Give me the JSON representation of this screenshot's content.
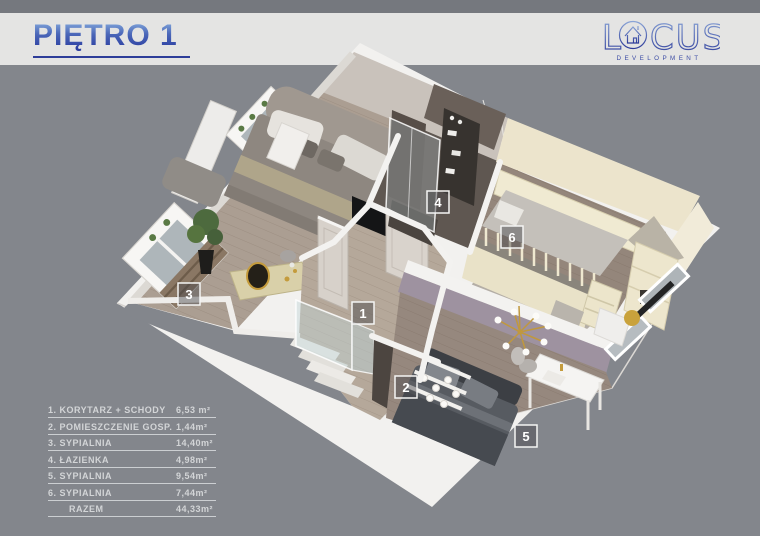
{
  "header": {
    "title": "PIĘTRO 1"
  },
  "logo": {
    "part1": "L",
    "part2": "CUS",
    "house_icon": "house-in-letter-o",
    "subtitle": "DEVELOPMENT",
    "color_top": "#8aa4d6",
    "color_bottom": "#2c3a99"
  },
  "rooms": [
    {
      "num": "1",
      "name": "KORYTARZ + SCHODY",
      "area": "6,53 m²"
    },
    {
      "num": "2",
      "name": "POMIESZCZENIE GOSP.",
      "area": "1,44m²"
    },
    {
      "num": "3",
      "name": "SYPIALNIA",
      "area": "14,40m²"
    },
    {
      "num": "4",
      "name": "ŁAZIENKA",
      "area": "4,98m²"
    },
    {
      "num": "5",
      "name": "SYPIALNIA",
      "area": "9,54m²"
    },
    {
      "num": "6",
      "name": "SYPIALNIA",
      "area": "7,44m²"
    }
  ],
  "legend": {
    "rows": [
      {
        "label": "1. KORYTARZ + SCHODY",
        "area": "6,53 m²"
      },
      {
        "label": "2. POMIESZCZENIE GOSP.",
        "area": "1,44m²"
      },
      {
        "label": "3. SYPIALNIA",
        "area": "14,40m²"
      },
      {
        "label": "4. ŁAZIENKA",
        "area": "4,98m²"
      },
      {
        "label": "5. SYPIALNIA",
        "area": "9,54m²"
      },
      {
        "label": "6. SYPIALNIA",
        "area": "7,44m²"
      }
    ],
    "total_label": "RAZEM",
    "total_area": "44,33m²"
  },
  "colors": {
    "background": "#83868c",
    "panel": "#e4e4e3",
    "accent_blue": "#2e3d99",
    "wall_white": "#f2f1ef",
    "wood": "#ab9e92",
    "bath_tile": "#5f5751",
    "kids_cream": "#ece4cc",
    "mauve_wall": "#9e92a0",
    "gold": "#c49b3c"
  }
}
